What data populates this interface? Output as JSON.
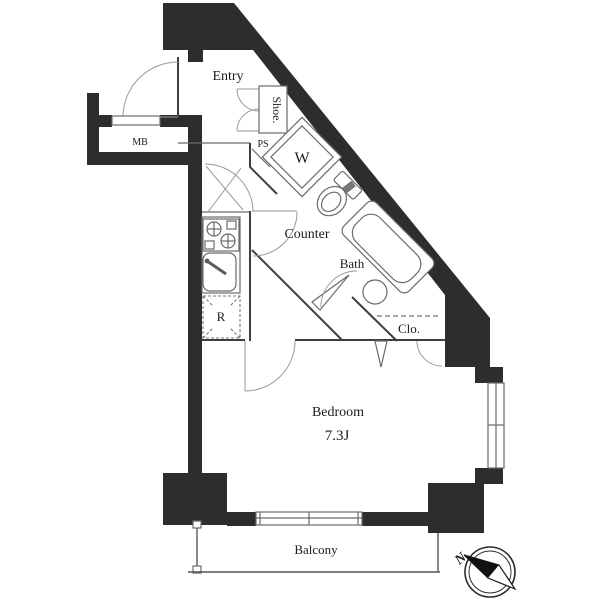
{
  "plan": {
    "rooms": {
      "entry": "Entry",
      "shoe": "Shoe.",
      "mb": "MB",
      "ps": "PS",
      "washer": "W",
      "counter": "Counter",
      "bath": "Bath",
      "closet": "Clo.",
      "fridge": "R",
      "bedroom": "Bedroom",
      "bedroom_size": "7.3J",
      "balcony": "Balcony"
    },
    "compass": {
      "north": "N"
    },
    "colors": {
      "wall": "#2d2d2d",
      "line": "#3f3f3f",
      "background": "#ffffff"
    }
  }
}
